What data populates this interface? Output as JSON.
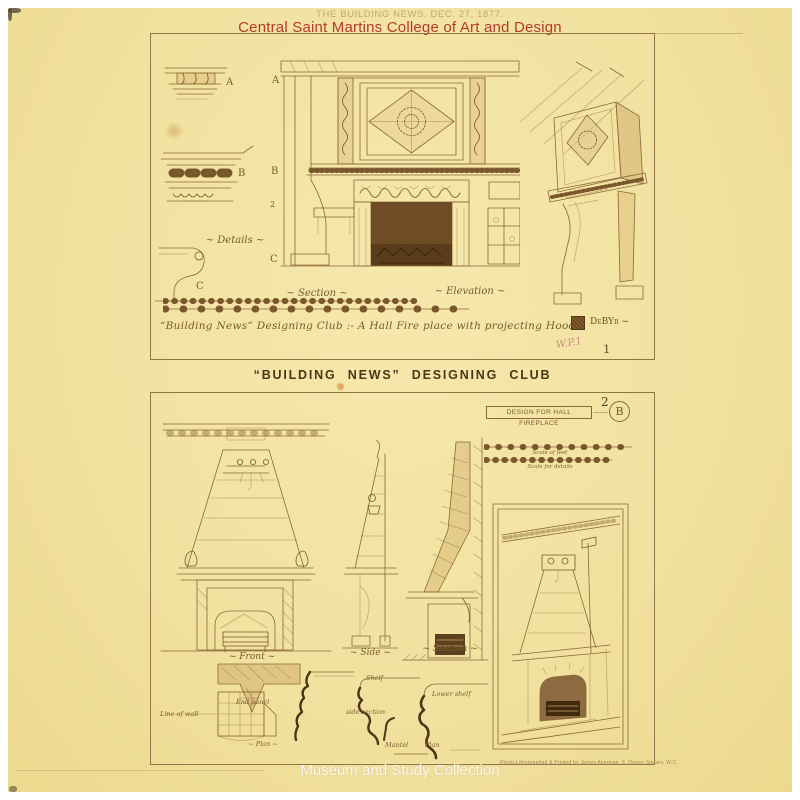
{
  "overlay": {
    "stamp": "THE BUILDING NEWS. DEC. 27. 1877.",
    "institution": "Central Saint Martins College of Art and Design",
    "collection": "Museum and Study Collection"
  },
  "plate1": {
    "marks": {
      "a1": "A",
      "b1": "B",
      "c1": "C",
      "a2": "A",
      "b2": "B",
      "n2": "2",
      "c2": "C"
    },
    "labels": {
      "details": "~ Details ~",
      "section": "~ Section ~",
      "elevation": "~ Elevation ~"
    },
    "caption": "“Building News” Designing Club :- A Hall Fire place with projecting Hood",
    "monogram_text": "DeBYr ~",
    "pencil_note": "W.P.1",
    "number": "1"
  },
  "divider": {
    "title": "“BUILDING NEWS” DESIGNING CLUB"
  },
  "plate2": {
    "number": "2",
    "title_box": "DESIGN FOR HALL FIREPLACE",
    "badge": "B",
    "scales": {
      "caption1": "Scale of feet",
      "caption2": "Scale for details"
    },
    "labels": {
      "front": "~ Front ~",
      "side": "~ Side ~",
      "section": "~ Section ~",
      "line_of_wall": "Line of wall",
      "end_panel": "End panel",
      "plan": "~ Plan ~",
      "shelf": "Shelf",
      "side_section": "side section",
      "lower_shelf": "Lower shelf",
      "mantel": "Mantel",
      "plan2": "Plan"
    },
    "credit": "Photo-Lithographed & Printed by James Akerman, 6, Queen Square, W.C."
  }
}
